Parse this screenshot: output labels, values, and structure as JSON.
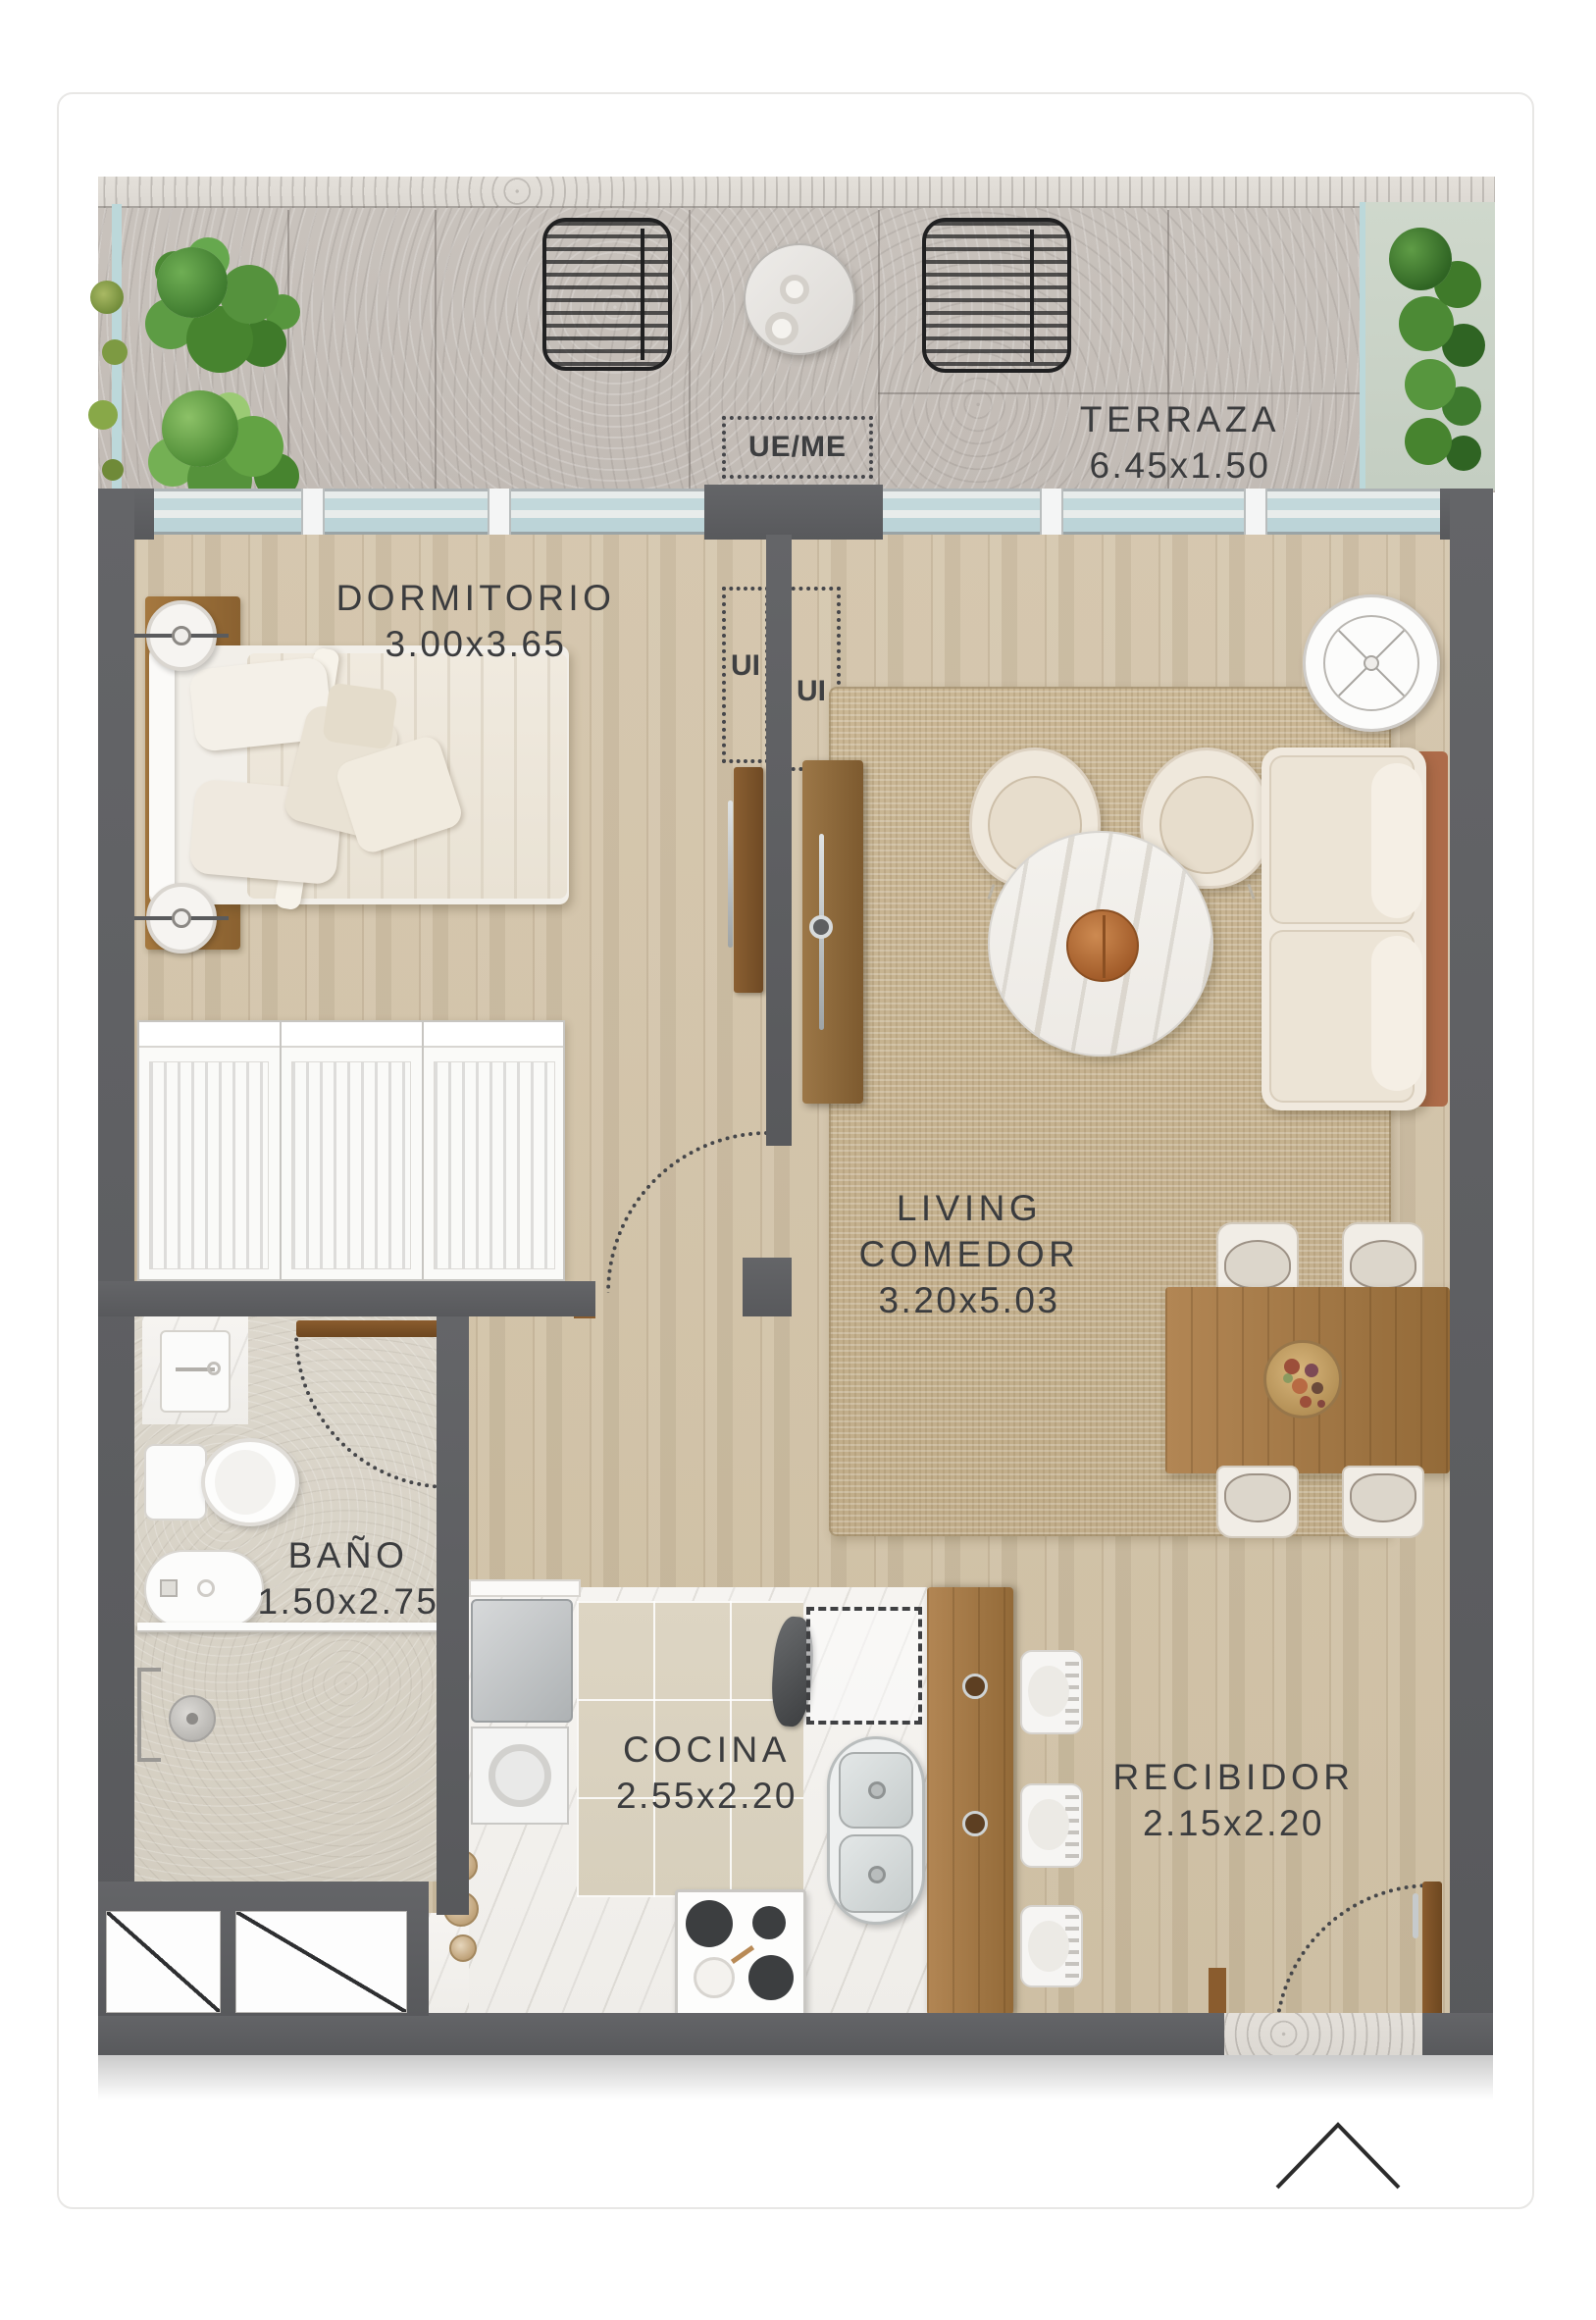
{
  "plan": {
    "rooms": {
      "terraza": {
        "name": "TERRAZA",
        "dims": "6.45x1.50"
      },
      "dormitorio": {
        "name": "DORMITORIO",
        "dims": "3.00x3.65"
      },
      "living_comedor": {
        "name_line1": "LIVING",
        "name_line2": "COMEDOR",
        "dims": "3.20x5.03"
      },
      "bano": {
        "name": "BAÑO",
        "dims": "1.50x2.75"
      },
      "cocina": {
        "name": "COCINA",
        "dims": "2.55x2.20"
      },
      "recibidor": {
        "name": "RECIBIDOR",
        "dims": "2.15x2.20"
      }
    },
    "annotations": {
      "ue_me": "UE/ME",
      "ui_left": "UI",
      "ui_right": "UI"
    },
    "colors": {
      "wall": "#5e5f62",
      "wood_floor": "#cfc0a6",
      "terrace_concrete": "#c8c2bc",
      "bath_floor": "#d9d4c9",
      "kitchen_tile": "#ded6c5",
      "rug": "#c9b591",
      "wood_furniture": "#a97f50",
      "glass": "#cfe0e3",
      "text": "#3b3c3e"
    },
    "icons": {
      "north_arrow": "chevron-up"
    }
  }
}
